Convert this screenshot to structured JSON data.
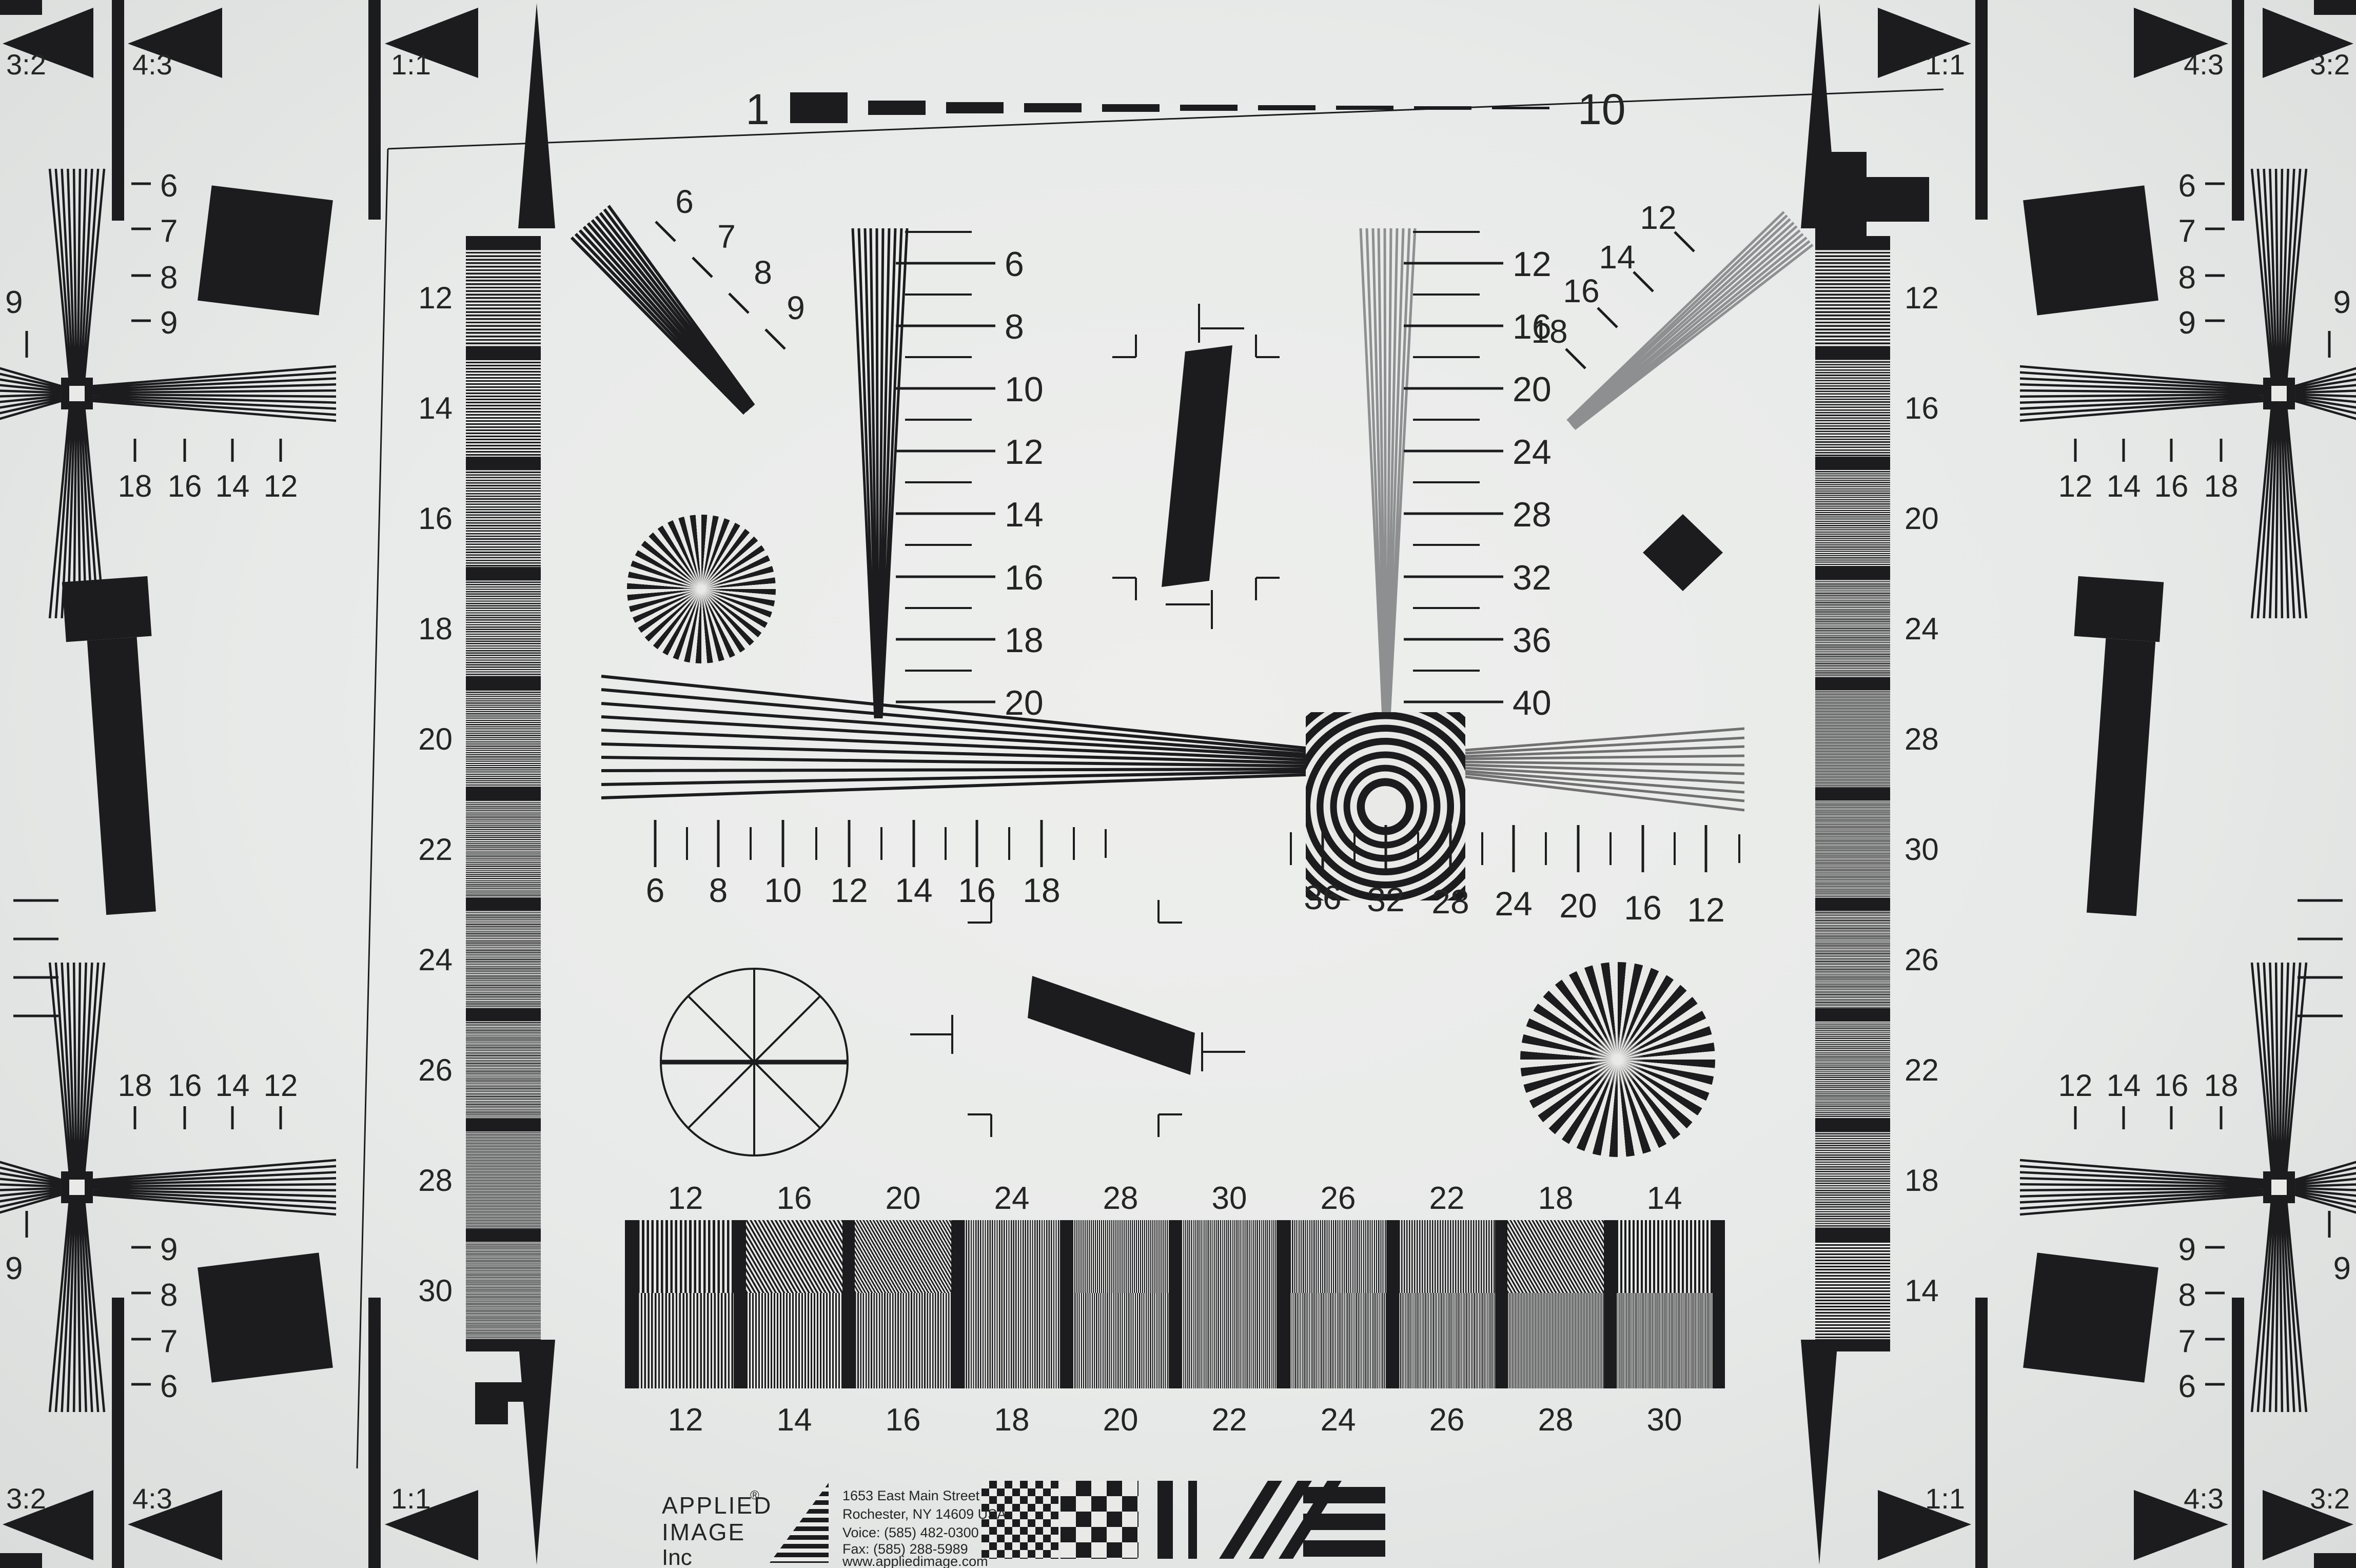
{
  "colors": {
    "paper": "#e9eae8",
    "ink": "#1c1c1e",
    "gray": "#8e8f90"
  },
  "aspect": {
    "r32": "3:2",
    "r43": "4:3",
    "r11": "1:1"
  },
  "ruler": {
    "left": "1",
    "right": "10"
  },
  "corner": {
    "vscale": [
      "6",
      "7",
      "8",
      "9"
    ],
    "hscale_left": [
      "18",
      "16",
      "14",
      "12"
    ],
    "hscale_right": [
      "12",
      "14",
      "16",
      "18"
    ],
    "edge": "9"
  },
  "wedge_a": [
    "6",
    "8",
    "10",
    "12",
    "14",
    "16",
    "18",
    "20"
  ],
  "wedge_b": [
    "12",
    "16",
    "20",
    "24",
    "28",
    "32",
    "36",
    "40"
  ],
  "diag_l": [
    "6",
    "7",
    "8",
    "9"
  ],
  "diag_r": [
    "18",
    "16",
    "14",
    "12"
  ],
  "hwedge_l": [
    "6",
    "8",
    "10",
    "12",
    "14",
    "16",
    "18"
  ],
  "hwedge_r": [
    "36",
    "32",
    "28",
    "24",
    "20",
    "16",
    "12"
  ],
  "strip_l": [
    "12",
    "14",
    "16",
    "18",
    "20",
    "22",
    "24",
    "26",
    "28",
    "30"
  ],
  "strip_r": [
    "12",
    "16",
    "20",
    "24",
    "28",
    "30",
    "26",
    "22",
    "18",
    "14"
  ],
  "tablet_top": [
    "12",
    "16",
    "20",
    "24",
    "28",
    "30",
    "26",
    "22",
    "18",
    "14"
  ],
  "tablet_bottom": [
    "12",
    "14",
    "16",
    "18",
    "20",
    "22",
    "24",
    "26",
    "28",
    "30"
  ],
  "logo": {
    "brand1": "APPLIED",
    "brand2": "IMAGE",
    "brand3": "Inc",
    "reg": "®",
    "addr1": "1653 East Main Street",
    "addr2": "Rochester, NY  14609  USA",
    "voice": "Voice:   (585) 482-0300",
    "fax": "Fax:     (585) 288-5989",
    "web": "www.appliedimage.com"
  }
}
